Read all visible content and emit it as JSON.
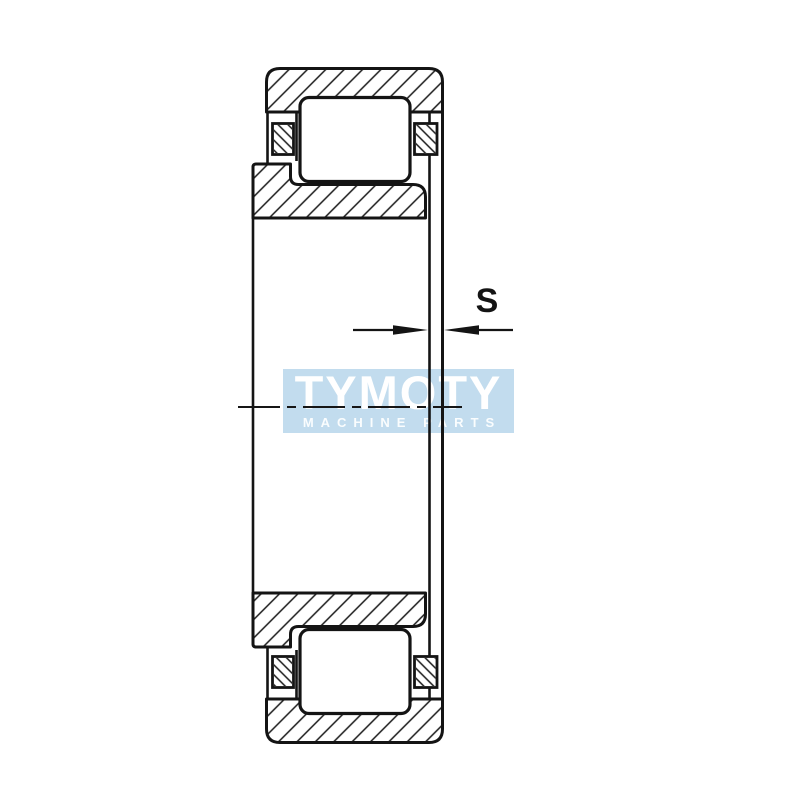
{
  "drawing": {
    "dimension_label": "S",
    "ink_color": "#141414"
  },
  "watermark": {
    "brand": "TYMOTY",
    "tagline": "MACHINE PARTS",
    "background_color": "#c2dcee",
    "text_color": "#ffffff"
  }
}
